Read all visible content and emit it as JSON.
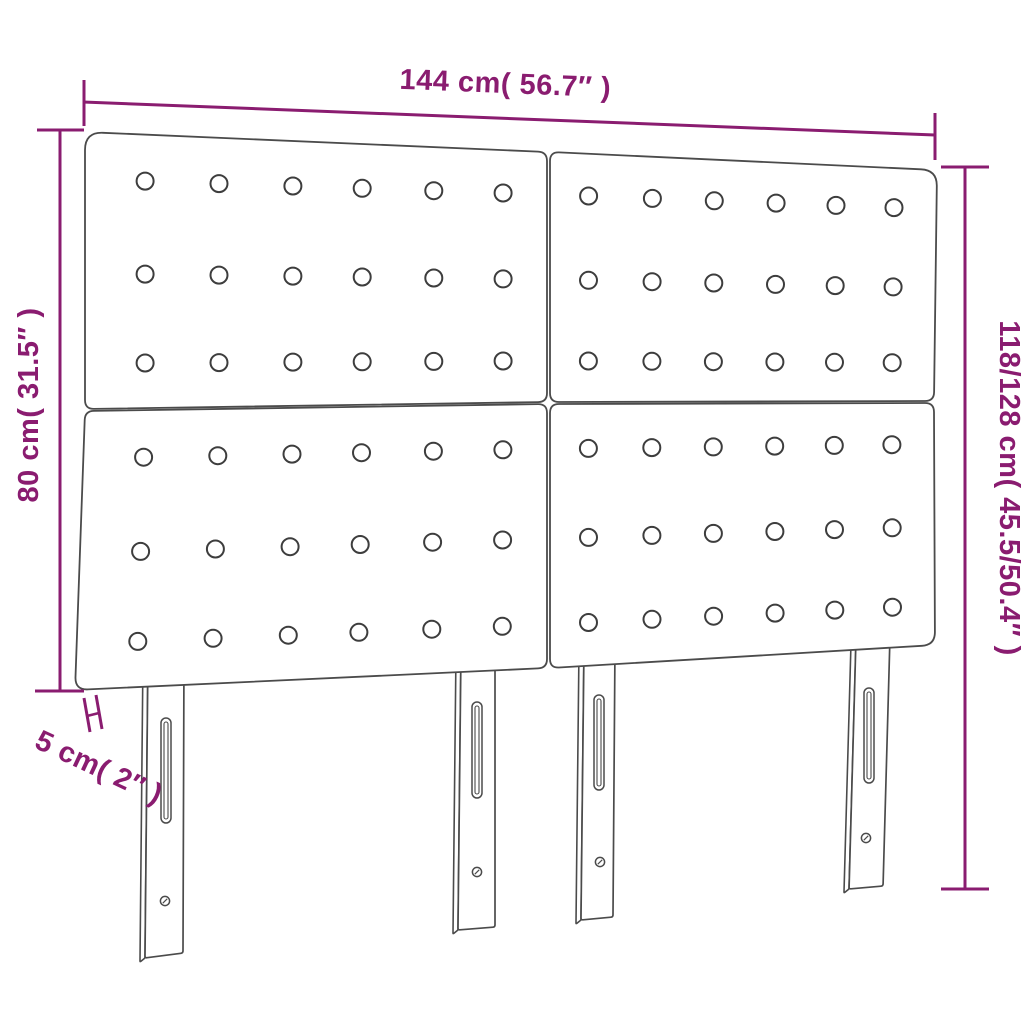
{
  "diagram": {
    "title": "headboard-dimension-diagram",
    "product": "upholstered headboard, 4 tufted panels, 4 adjustable legs",
    "accent_color": "#8A1C70",
    "line_color": "#4B4B4B",
    "background_color": "#FFFFFF",
    "dimensions": {
      "width": "144 cm( 56.7″ )",
      "panel_height": "80 cm( 31.5″ )",
      "total_height": "118/128 cm( 45.5/50.4″ )",
      "thickness": "5 cm( 2″ )"
    },
    "panels": {
      "grid_rows": 2,
      "grid_cols": 2,
      "buttons_per_panel_rows": 3,
      "buttons_per_panel_cols": 6
    },
    "legs": {
      "count": 4,
      "features": [
        "adjustment-slot",
        "screw-hole"
      ]
    }
  }
}
